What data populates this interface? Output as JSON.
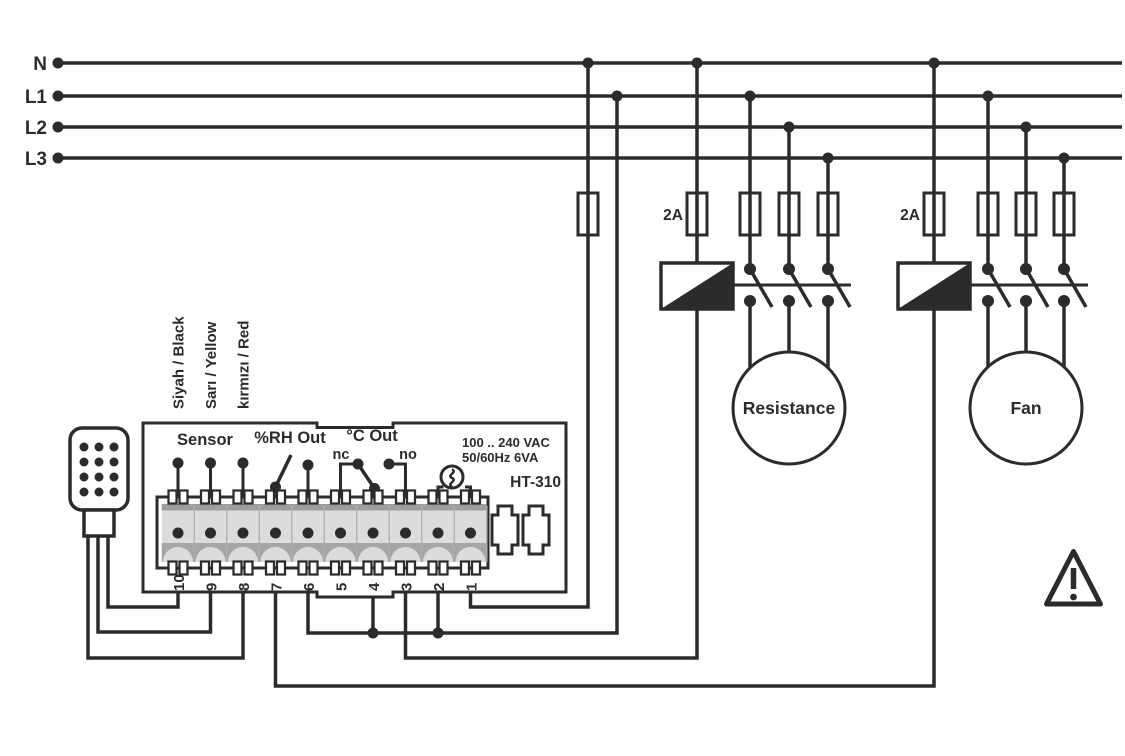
{
  "power_rails": {
    "n": "N",
    "l1": "L1",
    "l2": "L2",
    "l3": "L3"
  },
  "fuses": {
    "resistance_coil_rating": "2A",
    "fan_coil_rating": "2A"
  },
  "loads": {
    "resistance": "Resistance",
    "fan": "Fan"
  },
  "device": {
    "model": "HT-310",
    "rating_line1": "100 .. 240 VAC",
    "rating_line2": "50/60Hz 6VA",
    "sensor_label": "Sensor",
    "rh_out_label": "%RH Out",
    "c_out_label": "°C Out",
    "nc_label": "nc",
    "no_label": "no",
    "terminal_numbers": [
      "10",
      "9",
      "8",
      "7",
      "6",
      "5",
      "4",
      "3",
      "2",
      "1"
    ],
    "sensor_wire_labels": [
      "Siyah / Black",
      "Sarı / Yellow",
      "kırmızı / Red"
    ]
  },
  "colors": {
    "ink": "#2b2b2b",
    "terminal_cell": "#dcdcdc",
    "terminal_shadow": "#a6a6a6",
    "terminal_topbar": "#9e9e9e",
    "background": "#ffffff"
  }
}
